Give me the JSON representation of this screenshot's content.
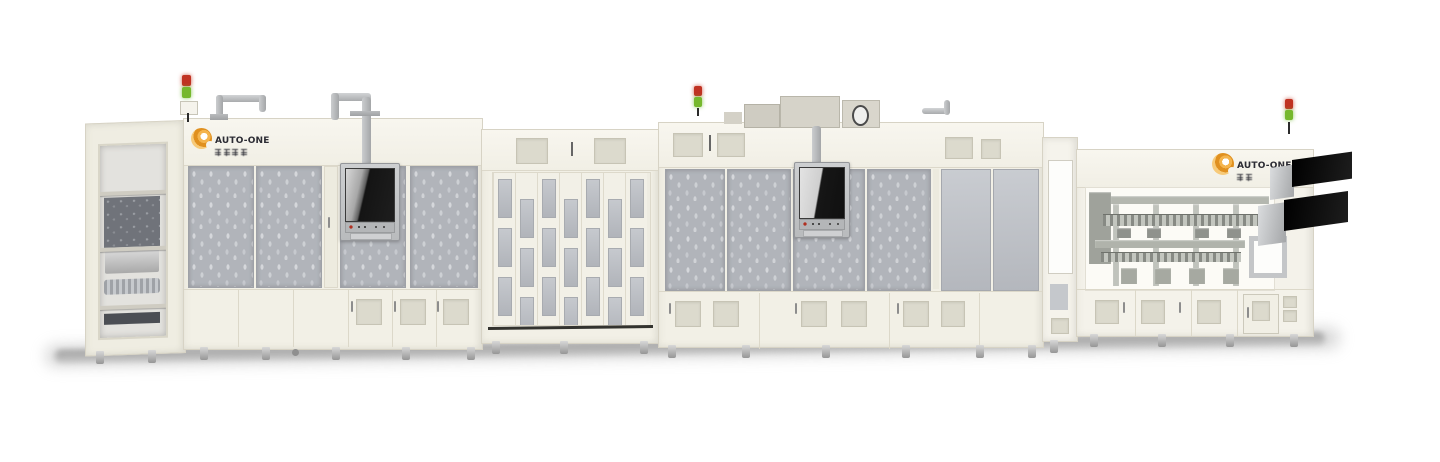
{
  "scene": {
    "background_color": "#ffffff",
    "module_count": 4,
    "stack_light_count": 3
  },
  "branding": {
    "logo_text": "AUTO-ONE",
    "logo_subtext_note": "small blurred Chinese characters under wordmark",
    "logo_accent_color": "#e0901f"
  },
  "colors": {
    "cabinet_body": "#f2f0e6",
    "mesh_panel_gray": "#b1b4ba",
    "hmi_screen_dark": "#161616",
    "black_side_plate": "#0d0d0d",
    "stack_light_red": "#c03222",
    "stack_light_green": "#76b82d",
    "floor_shadow": "#9f9f9f"
  }
}
